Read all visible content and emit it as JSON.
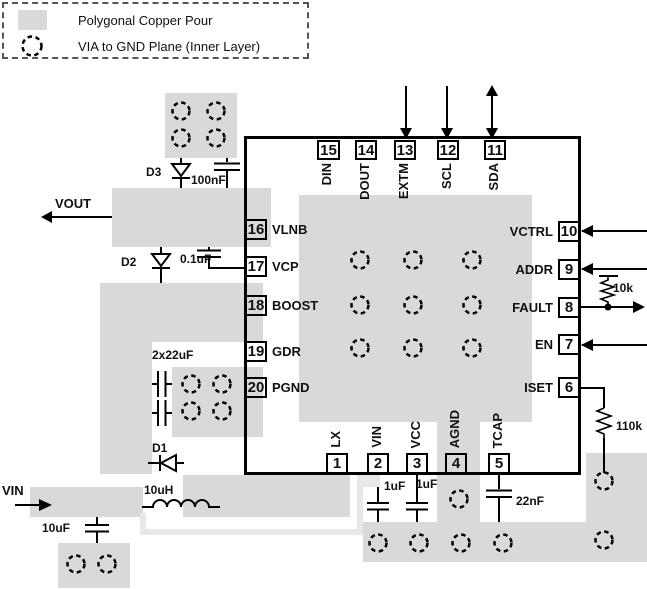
{
  "legend": {
    "copper_pour_label": "Polygonal Copper Pour",
    "via_gnd_label": "VIA to GND Plane (Inner Layer)"
  },
  "nets": {
    "vout": "VOUT",
    "vin": "VIN"
  },
  "components": {
    "d1": "D1",
    "d2": "D2",
    "d3": "D3",
    "c_100nf": "100nF",
    "c_0p1uf": "0.1uF",
    "c_2x22uf": "2x22uF",
    "l_10uh": "10uH",
    "c_10uf": "10uF",
    "c_1uf_vin": "1uF",
    "c_1uf_vcc": "1uF",
    "c_22nf": "22nF",
    "r_10k": "10k",
    "r_110k": "110k"
  },
  "ic": {
    "pins": {
      "top": [
        {
          "num": "15",
          "name": "DIN"
        },
        {
          "num": "14",
          "name": "DOUT"
        },
        {
          "num": "13",
          "name": "EXTM"
        },
        {
          "num": "12",
          "name": "SCL"
        },
        {
          "num": "11",
          "name": "SDA"
        }
      ],
      "bottom": [
        {
          "num": "1",
          "name": "LX"
        },
        {
          "num": "2",
          "name": "VIN"
        },
        {
          "num": "3",
          "name": "VCC"
        },
        {
          "num": "4",
          "name": "AGND"
        },
        {
          "num": "5",
          "name": "TCAP"
        }
      ],
      "left": [
        {
          "num": "16",
          "name": "VLNB"
        },
        {
          "num": "17",
          "name": "VCP"
        },
        {
          "num": "18",
          "name": "BOOST"
        },
        {
          "num": "19",
          "name": "GDR"
        },
        {
          "num": "20",
          "name": "PGND"
        }
      ],
      "right": [
        {
          "num": "10",
          "name": "VCTRL"
        },
        {
          "num": "9",
          "name": "ADDR"
        },
        {
          "num": "8",
          "name": "FAULT"
        },
        {
          "num": "7",
          "name": "EN"
        },
        {
          "num": "6",
          "name": "ISET"
        }
      ]
    }
  },
  "colors": {
    "pour": "#d9d9d9",
    "trace": "#e8e8e8",
    "line": "#000000"
  }
}
